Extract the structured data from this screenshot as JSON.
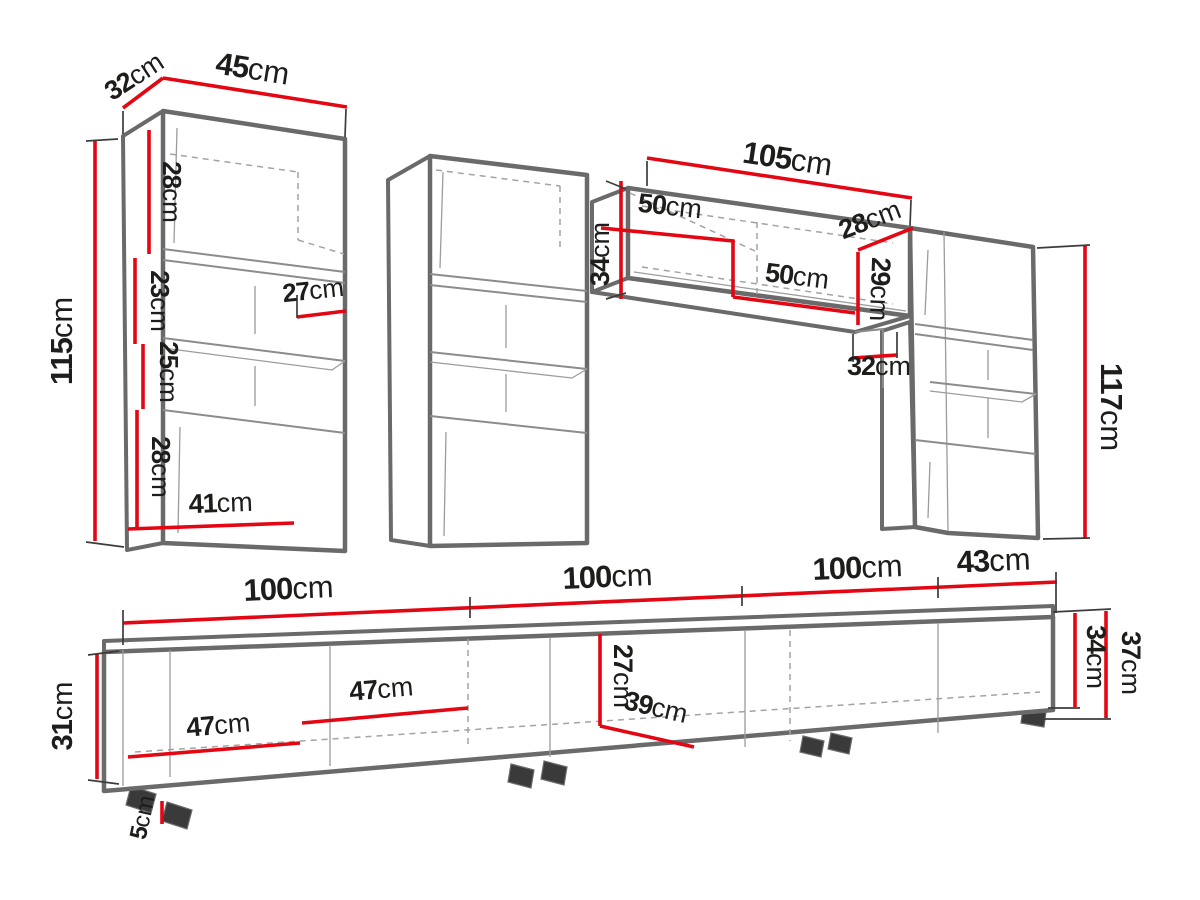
{
  "diagram": {
    "kind": "furniture-dimension-drawing",
    "unit": "cm",
    "colors": {
      "dimension_red": "#e30613",
      "outline_gray": "#6a6a6a",
      "text": "#1d1d1b"
    }
  },
  "pieces": {
    "tall_cabinet_left": {
      "depth": {
        "value": "32",
        "unit": "cm"
      },
      "width": {
        "value": "45",
        "unit": "cm"
      },
      "height": {
        "value": "115",
        "unit": "cm"
      },
      "top_section_height": {
        "value": "28",
        "unit": "cm"
      },
      "upper_shelf_spacing": {
        "value": "23",
        "unit": "cm"
      },
      "lower_shelf_spacing": {
        "value": "25",
        "unit": "cm"
      },
      "bottom_section_height": {
        "value": "28",
        "unit": "cm"
      },
      "shelf_depth": {
        "value": "27",
        "unit": "cm"
      },
      "interior_width": {
        "value": "41",
        "unit": "cm"
      }
    },
    "wall_cabinet": {
      "width": {
        "value": "105",
        "unit": "cm"
      },
      "left_compartment_width": {
        "value": "50",
        "unit": "cm"
      },
      "height": {
        "value": "34",
        "unit": "cm"
      },
      "depth": {
        "value": "28",
        "unit": "cm"
      },
      "interior_height": {
        "value": "29",
        "unit": "cm"
      },
      "right_compartment_width": {
        "value": "50",
        "unit": "cm"
      },
      "side_clearance": {
        "value": "32",
        "unit": "cm"
      }
    },
    "tall_cabinet_right": {
      "height": {
        "value": "117",
        "unit": "cm"
      }
    },
    "tv_stand": {
      "section1_width": {
        "value": "100",
        "unit": "cm"
      },
      "section2_width": {
        "value": "100",
        "unit": "cm"
      },
      "section3_width": {
        "value": "100",
        "unit": "cm"
      },
      "end_section_width": {
        "value": "43",
        "unit": "cm"
      },
      "front_height": {
        "value": "31",
        "unit": "cm"
      },
      "compartment1_width": {
        "value": "47",
        "unit": "cm"
      },
      "compartment2_width": {
        "value": "47",
        "unit": "cm"
      },
      "interior_height": {
        "value": "27",
        "unit": "cm"
      },
      "depth": {
        "value": "39",
        "unit": "cm"
      },
      "right_interior_height": {
        "value": "34",
        "unit": "cm"
      },
      "right_total_height": {
        "value": "37",
        "unit": "cm"
      },
      "leg_height": {
        "value": "5",
        "unit": "cm"
      }
    }
  }
}
